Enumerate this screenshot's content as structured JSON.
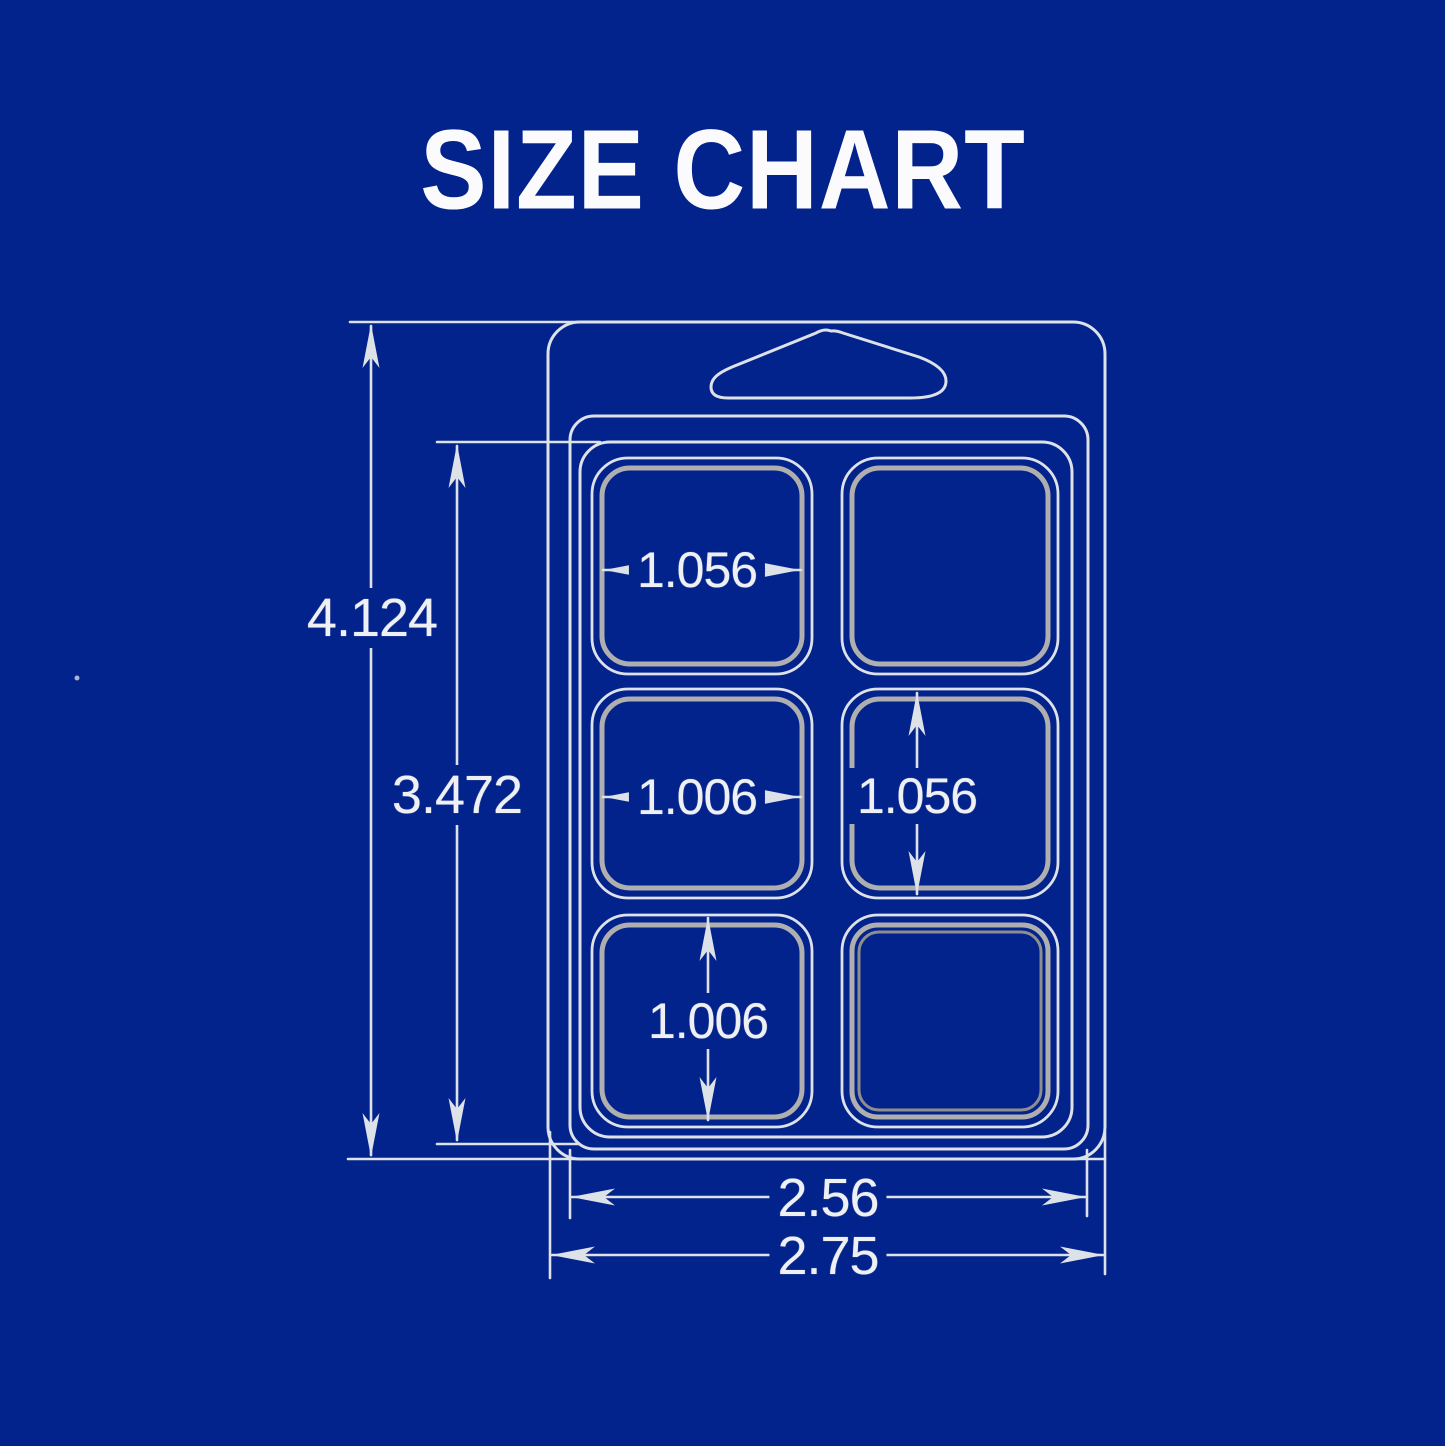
{
  "title": "SIZE CHART",
  "colors": {
    "background": "#02228C",
    "line": "#DDE1E8",
    "line_inner": "#AFAFAF",
    "text": "#EEF0F4"
  },
  "figure": {
    "type": "clamshell wax-melt packaging technical drawing",
    "cavity_rows": 3,
    "cavity_columns": 2
  },
  "dimensions": {
    "overall_height": "4.124",
    "tray_height": "3.472",
    "cavity_width_top": "1.056",
    "cavity_width_middle": "1.006",
    "cavity_height_middle": "1.056",
    "cavity_height_bottom": "1.006",
    "inner_width": "2.56",
    "overall_width": "2.75"
  }
}
